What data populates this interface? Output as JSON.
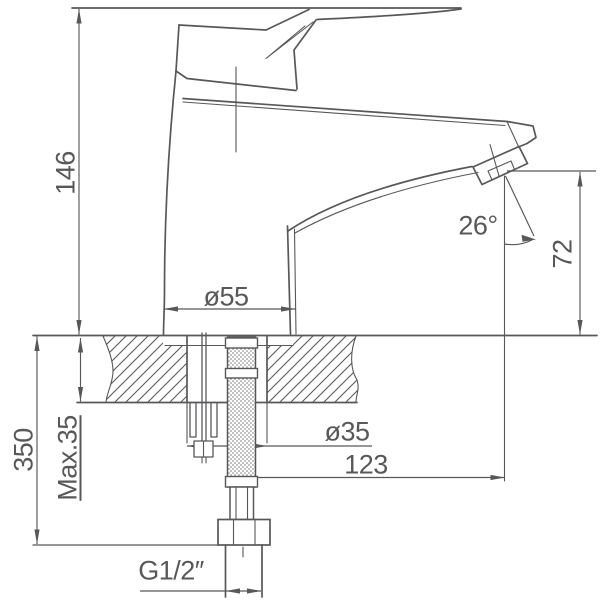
{
  "colors": {
    "line": "#58585b",
    "background": "#ffffff"
  },
  "labels": {
    "total_height": "146",
    "below_counter_height": "350",
    "max_counter_thickness": "Max.35",
    "base_diameter": "ø55",
    "hole_diameter": "ø35",
    "spout_reach": "123",
    "outlet_height": "72",
    "stream_angle": "26°",
    "connection_thread": "G1/2″"
  }
}
